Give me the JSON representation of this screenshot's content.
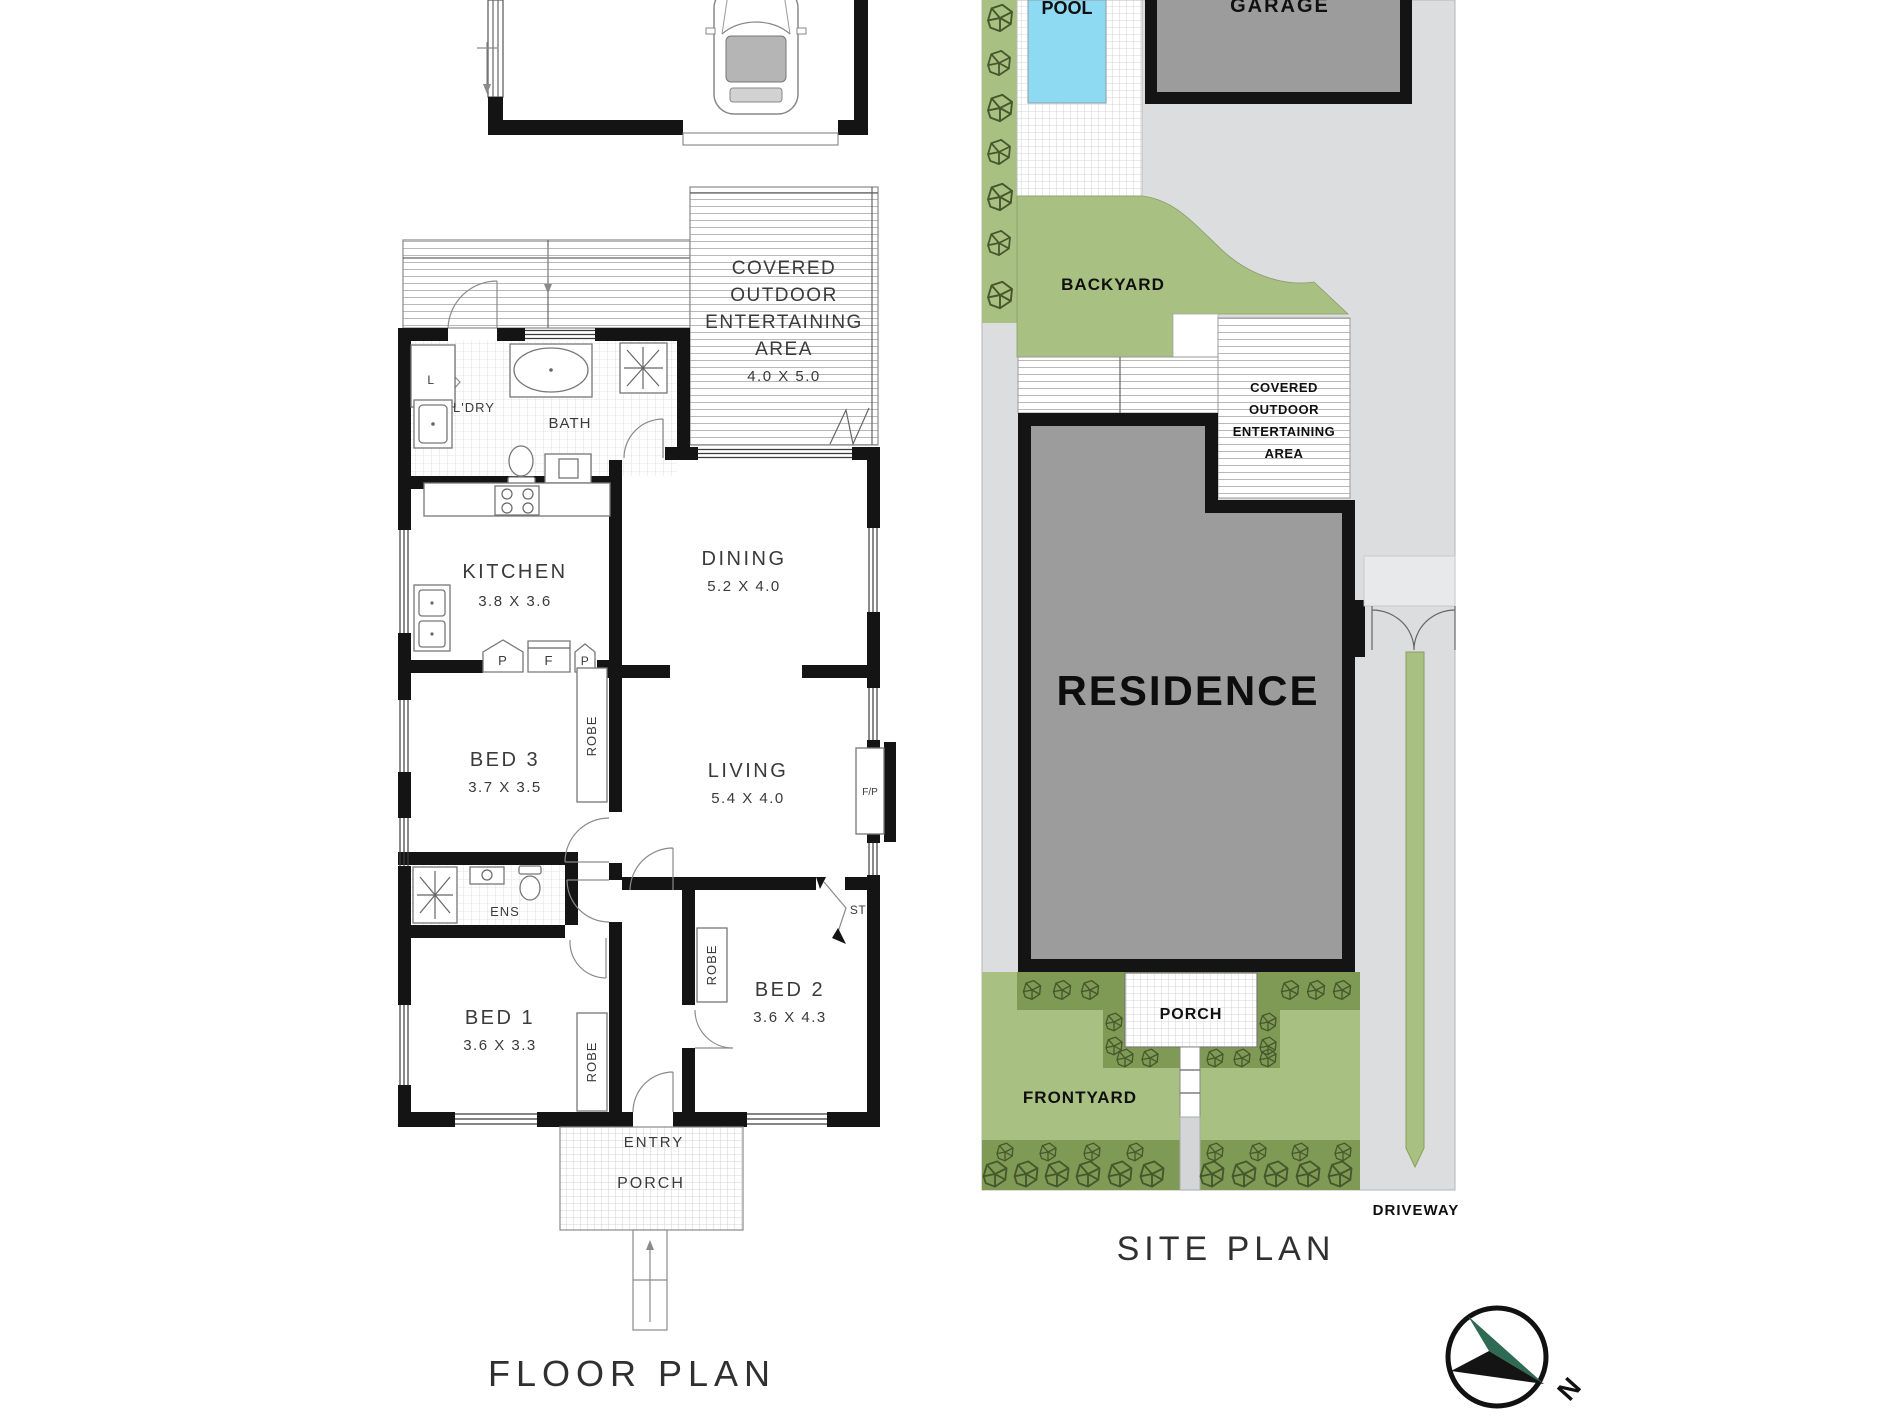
{
  "floor_plan": {
    "title": "FLOOR PLAN",
    "rooms": {
      "laundry": {
        "label": "L'DRY"
      },
      "linen": {
        "label": "L"
      },
      "bath": {
        "label": "BATH"
      },
      "kitchen": {
        "label": "KITCHEN",
        "dims": "3.8 X 3.6"
      },
      "dining": {
        "label": "DINING",
        "dims": "5.2 X 4.0"
      },
      "covered_outdoor": {
        "lines": [
          "COVERED",
          "OUTDOOR",
          "ENTERTAINING",
          "AREA"
        ],
        "dims": "4.0 X 5.0"
      },
      "bed3": {
        "label": "BED 3",
        "dims": "3.7 X 3.5"
      },
      "living": {
        "label": "LIVING",
        "dims": "5.4 X 4.0"
      },
      "ens": {
        "label": "ENS"
      },
      "bed1": {
        "label": "BED 1",
        "dims": "3.6 X 3.3"
      },
      "bed2": {
        "label": "BED 2",
        "dims": "3.6 X 4.3"
      },
      "entry": {
        "label": "ENTRY"
      },
      "porch": {
        "label": "PORCH"
      }
    },
    "fixtures": {
      "robe": "ROBE",
      "pantry": "P",
      "fridge": "F",
      "store": "ST",
      "fireplace": "F/P"
    }
  },
  "site_plan": {
    "title": "SITE PLAN",
    "areas": {
      "pool": {
        "label": "POOL"
      },
      "garage": {
        "label": "GARAGE"
      },
      "backyard": {
        "label": "BACKYARD"
      },
      "covered_outdoor": {
        "lines": [
          "COVERED",
          "OUTDOOR",
          "ENTERTAINING",
          "AREA"
        ]
      },
      "residence": {
        "label": "RESIDENCE"
      },
      "porch": {
        "label": "PORCH"
      },
      "frontyard": {
        "label": "FRONTYARD"
      },
      "driveway": {
        "label": "DRIVEWAY"
      }
    },
    "compass": {
      "north": "N"
    },
    "colors": {
      "grass": "#a9c083",
      "shrub": "#7e9a55",
      "plant_line": "#46572c",
      "pool_water": "#8edaf3",
      "paving": "#dcdddf",
      "building_gray": "#9c9c9c",
      "wall_black": "#141414",
      "compass_green": "#2e6b52"
    }
  }
}
